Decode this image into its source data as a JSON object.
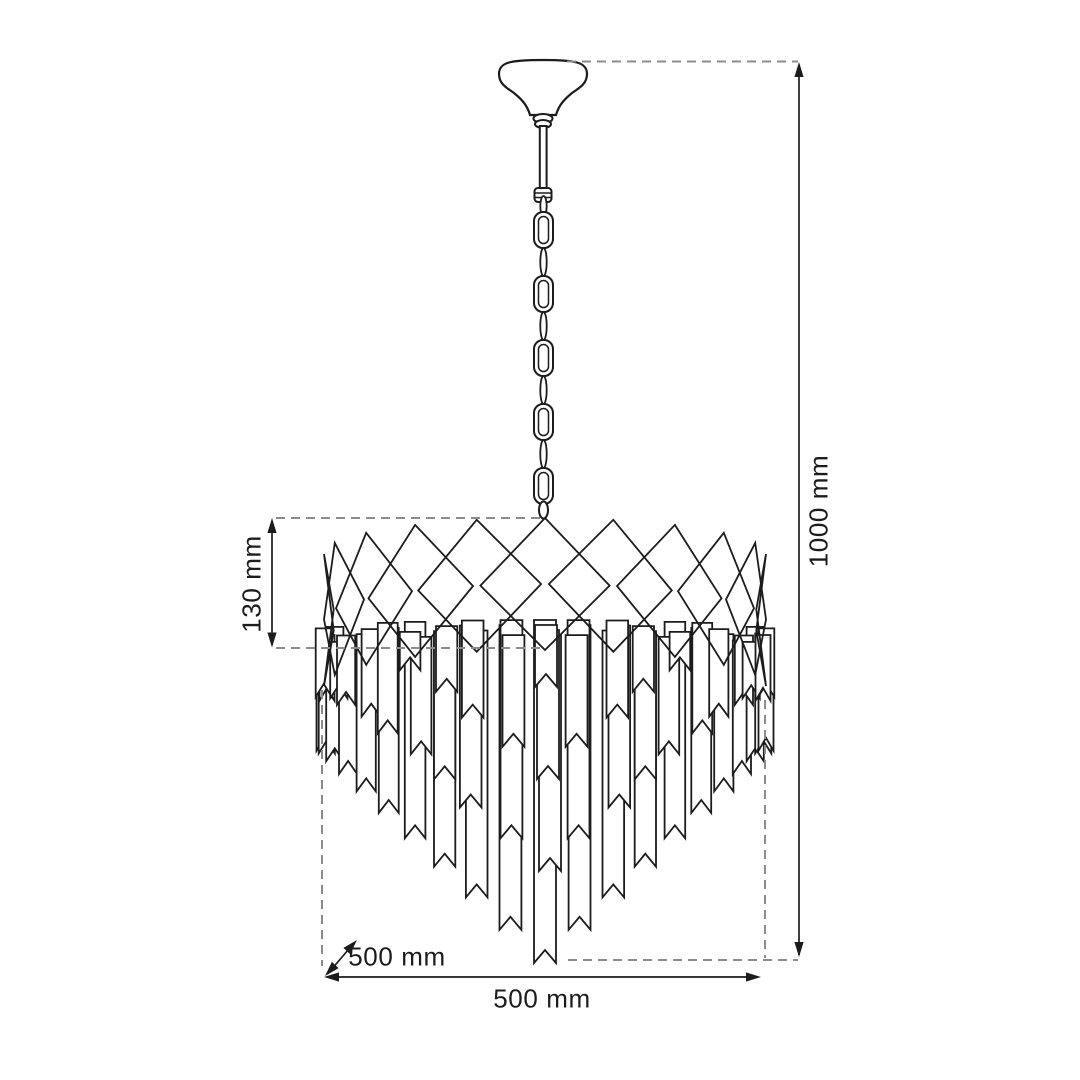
{
  "figure": {
    "subject": "Chandelier technical dimension drawing",
    "annotations": {
      "total_height": "1000 mm",
      "crown_height": "130 mm",
      "width": "500 mm",
      "depth": "500 mm"
    },
    "colors": {
      "line": "#1c1c1c",
      "dashed": "#8c8c8c",
      "text": "#1c1c1c",
      "background": "#ffffff"
    }
  }
}
